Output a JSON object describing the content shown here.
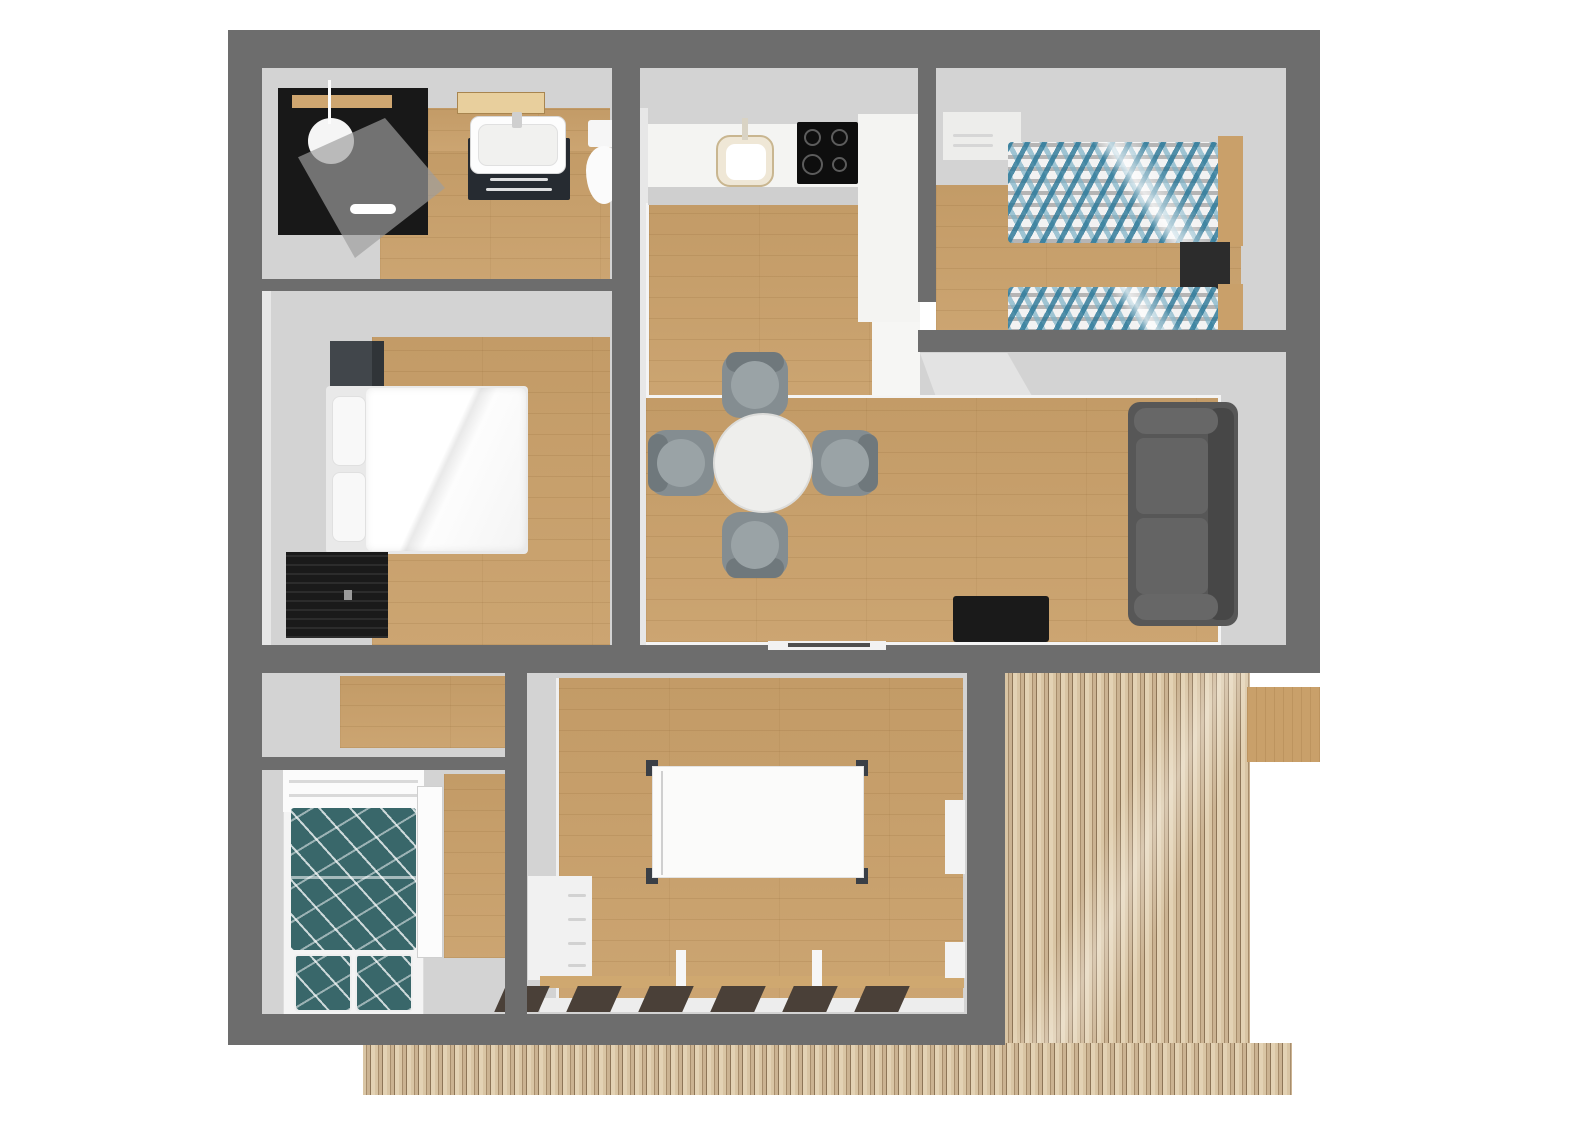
{
  "scene": {
    "type": "floor-plan-3d-top-view",
    "background": "#ffffff"
  },
  "palette": {
    "wall": "#6d6d6d",
    "floor_gray": "#d3d3d3",
    "wood": "#c9a06a",
    "wood_dark": "#b8905c",
    "deck_a": "#d9c5a4",
    "deck_b": "#a78d6c",
    "deck_c": "#cbb392",
    "deck_d": "#8d7557",
    "deck_e": "#e3d2b4",
    "white_furn": "#f4f4f2",
    "black_furn": "#1a1a1a",
    "dark_nightstand": "#41464b",
    "sofa": "#575757",
    "sofa_dark": "#474747",
    "sofa_light": "#676767",
    "chair": "#848d91",
    "chair_back": "#6f787c",
    "chair_seat": "#9aa3a6",
    "duvet_blue": "#2c7898",
    "duvet_blue_light": "#7eb2c7",
    "duvet_gray": "#7d7d7d",
    "bunk_teal": "#39676a",
    "headboard": "#c9a06a",
    "table_white": "#fbfbfa"
  },
  "rooms": [
    {
      "id": "bathroom",
      "name": "bathroom",
      "furniture": [
        "shower-cabin",
        "vanity-sink",
        "toilet"
      ]
    },
    {
      "id": "bedroom-double",
      "name": "double bedroom",
      "furniture": [
        "nightstand",
        "double-bed",
        "dresser"
      ]
    },
    {
      "id": "kitchen",
      "name": "kitchen",
      "furniture": [
        "counter",
        "round-sink",
        "cooktop",
        "tall-unit"
      ]
    },
    {
      "id": "bedroom-twin",
      "name": "twin bedroom",
      "furniture": [
        "white-dresser",
        "twin-bed",
        "nightstand",
        "twin-bed"
      ]
    },
    {
      "id": "living-dining",
      "name": "living dining room",
      "furniture": [
        "round-table",
        "chair",
        "chair",
        "chair",
        "chair",
        "sofa",
        "tv-bench"
      ]
    },
    {
      "id": "hallway",
      "name": "hallway",
      "furniture": []
    },
    {
      "id": "bunk-room",
      "name": "bunk room",
      "furniture": [
        "bunk-bed",
        "open-door"
      ]
    },
    {
      "id": "garden-room",
      "name": "garden room",
      "furniture": [
        "rectangular-table",
        "drawer-cabinet",
        "glazed-wall"
      ]
    },
    {
      "id": "deck",
      "name": "timber deck",
      "furniture": [
        "doormat"
      ]
    }
  ]
}
